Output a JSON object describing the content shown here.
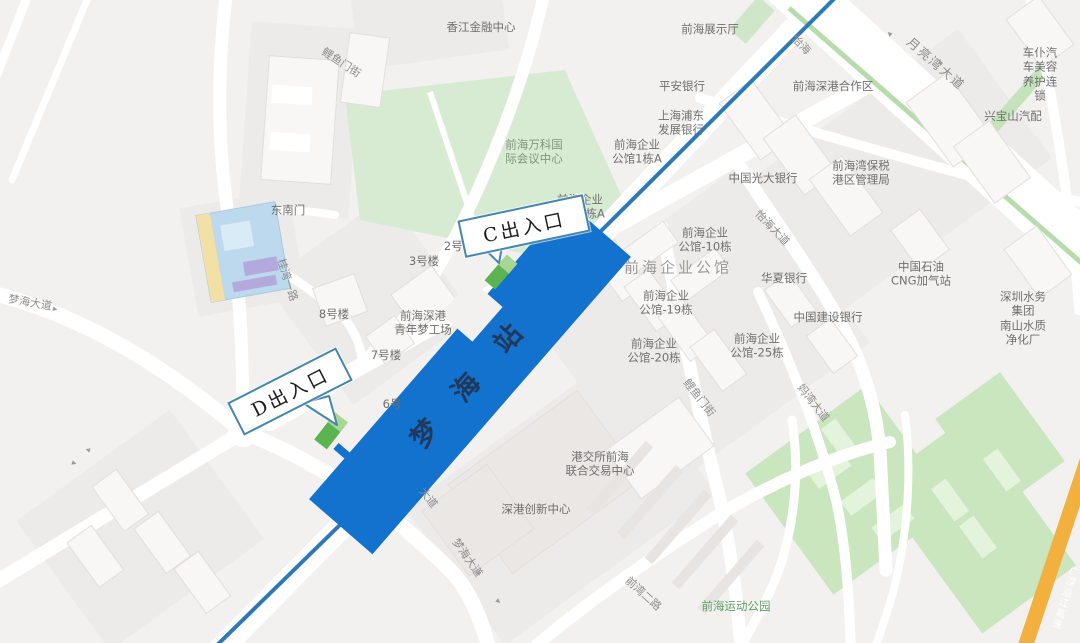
{
  "map_title": "梦海站周边地图",
  "station": {
    "name": "梦海站",
    "chars": [
      {
        "ch": "梦",
        "x": 423,
        "y": 432
      },
      {
        "ch": "海",
        "x": 464,
        "y": 386
      },
      {
        "ch": "站",
        "x": 506,
        "y": 337
      }
    ]
  },
  "callouts": [
    {
      "id": "callout-exit-c",
      "text": "C出入口",
      "x": 522,
      "y": 224,
      "rot": -12,
      "w": 124,
      "h": 34
    },
    {
      "id": "callout-exit-d",
      "text": "D出入口",
      "x": 288,
      "y": 389,
      "rot": -27,
      "w": 118,
      "h": 33
    }
  ],
  "exits": [
    {
      "id": "exit-c",
      "x": 501,
      "y": 272,
      "rot": 41
    },
    {
      "id": "exit-d",
      "x": 331,
      "y": 431,
      "rot": 38
    }
  ],
  "labels": [
    {
      "id": "road-liyumen-street-nw",
      "text": "鲤鱼门街",
      "x": 341,
      "y": 63,
      "rot": 33,
      "cls": "road"
    },
    {
      "id": "poi-xiangjiang-financial-center",
      "text": "香江金融中心",
      "x": 481,
      "y": 27,
      "cls": "poi"
    },
    {
      "id": "poi-qianhai-exhibition-hall",
      "text": "前海展示厅",
      "x": 710,
      "y": 29,
      "cls": "poi"
    },
    {
      "id": "road-yihai",
      "text": "怡海",
      "x": 801,
      "y": 45,
      "rot": 46,
      "cls": "road"
    },
    {
      "id": "road-moon-bay-blvd",
      "text": "月亮湾大道",
      "x": 936,
      "y": 64,
      "rot": 41,
      "cls": "road-big"
    },
    {
      "id": "poi-chepu-auto-beauty",
      "text": "车仆汽车美容\n养护连锁",
      "x": 1040,
      "y": 74,
      "cls": "poi"
    },
    {
      "id": "poi-xingbaoshan-auto-parts",
      "text": "兴宝山汽配",
      "x": 1013,
      "y": 116,
      "cls": "poi"
    },
    {
      "id": "poi-pingan-bank",
      "text": "平安银行",
      "x": 682,
      "y": 86,
      "cls": "poi"
    },
    {
      "id": "poi-spdb-bank",
      "text": "上海浦东\n发展银行",
      "x": 681,
      "y": 123,
      "cls": "poi"
    },
    {
      "id": "poi-qianhai-shengang-cooperation-zone",
      "text": "前海深港合作区",
      "x": 833,
      "y": 86,
      "cls": "poi"
    },
    {
      "id": "poi-bonded-port-authority",
      "text": "前海湾保税\n港区管理局",
      "x": 861,
      "y": 173,
      "cls": "poi"
    },
    {
      "id": "poi-china-everbright-bank",
      "text": "中国光大银行",
      "x": 763,
      "y": 178,
      "cls": "poi"
    },
    {
      "id": "poi-vanke-intl-conference-center",
      "text": "前海万科国\n际会议中心",
      "x": 534,
      "y": 152,
      "cls": "park-label"
    },
    {
      "id": "poi-gongguan-1a",
      "text": "前海企业\n公馆1栋A",
      "x": 637,
      "y": 152,
      "cls": "poi"
    },
    {
      "id": "poi-southeast-gate",
      "text": "东南门",
      "x": 288,
      "y": 210,
      "cls": "poi"
    },
    {
      "id": "poi-gongguan-7a",
      "text": "前海企业\n公馆7栋A",
      "x": 580,
      "y": 207,
      "cls": "poi"
    },
    {
      "id": "poi-building-2",
      "text": "2号楼",
      "x": 459,
      "y": 246,
      "cls": "poi"
    },
    {
      "id": "poi-building-3",
      "text": "3号楼",
      "x": 424,
      "y": 261,
      "cls": "poi"
    },
    {
      "id": "road-guiwan-1st",
      "text": "桂湾一路",
      "x": 287,
      "y": 280,
      "rot": 72,
      "cls": "road"
    },
    {
      "id": "poi-building-8",
      "text": "8号楼",
      "x": 334,
      "y": 314,
      "cls": "poi"
    },
    {
      "id": "road-yihai-blvd",
      "text": "怡海大道",
      "x": 772,
      "y": 228,
      "rot": 46,
      "cls": "road"
    },
    {
      "id": "poi-gongguan-10",
      "text": "前海企业\n公馆-10栋",
      "x": 705,
      "y": 240,
      "cls": "poi"
    },
    {
      "id": "poi-qianhai-enterprise-mansion",
      "text": "前海企业公馆",
      "x": 678,
      "y": 268,
      "cls": "poi-big"
    },
    {
      "id": "poi-huaxia-bank",
      "text": "华夏银行",
      "x": 784,
      "y": 278,
      "cls": "poi"
    },
    {
      "id": "poi-cnpc-cng-station",
      "text": "中国石油\nCNG加气站",
      "x": 921,
      "y": 274,
      "cls": "poi"
    },
    {
      "id": "poi-gongguan-19",
      "text": "前海企业\n公馆-19栋",
      "x": 666,
      "y": 303,
      "cls": "poi"
    },
    {
      "id": "poi-ccb-bank",
      "text": "中国建设银行",
      "x": 828,
      "y": 317,
      "cls": "poi"
    },
    {
      "id": "poi-shenzhen-water-group",
      "text": "深圳水务集团\n南山水质净化厂",
      "x": 1023,
      "y": 318,
      "cls": "poi"
    },
    {
      "id": "poi-youth-dream-works",
      "text": "前海深港\n青年梦工场",
      "x": 423,
      "y": 323,
      "cls": "poi"
    },
    {
      "id": "poi-building-7",
      "text": "7号楼",
      "x": 386,
      "y": 355,
      "cls": "poi"
    },
    {
      "id": "poi-gongguan-20",
      "text": "前海企业\n公馆-20栋",
      "x": 654,
      "y": 351,
      "cls": "poi"
    },
    {
      "id": "poi-gongguan-25",
      "text": "前海企业\n公馆-25栋",
      "x": 757,
      "y": 346,
      "cls": "poi"
    },
    {
      "id": "road-liyumen-street-e",
      "text": "鲤鱼门街",
      "x": 699,
      "y": 398,
      "rot": 52,
      "cls": "road"
    },
    {
      "id": "road-mawan-blvd",
      "text": "妈湾大道",
      "x": 813,
      "y": 403,
      "rot": 52,
      "cls": "road"
    },
    {
      "id": "road-menghai-blvd-w",
      "text": "梦海大道",
      "x": 30,
      "y": 303,
      "rot": 10,
      "cls": "road"
    },
    {
      "id": "poi-building-6",
      "text": "6号",
      "x": 392,
      "y": 404,
      "cls": "poi"
    },
    {
      "id": "road-tinghai-blvd-fragment",
      "text": "大道",
      "x": 428,
      "y": 498,
      "rot": 52,
      "cls": "road"
    },
    {
      "id": "poi-hkex-qianhai-center",
      "text": "港交所前海\n联合交易中心",
      "x": 600,
      "y": 464,
      "cls": "poi"
    },
    {
      "id": "poi-shengang-innovation-center",
      "text": "深港创新中心",
      "x": 536,
      "y": 509,
      "cls": "poi"
    },
    {
      "id": "road-menghai-blvd-s",
      "text": "梦海大道",
      "x": 467,
      "y": 558,
      "rot": 55,
      "cls": "road"
    },
    {
      "id": "road-qianwan-2nd",
      "text": "前湾二路",
      "x": 643,
      "y": 594,
      "rot": 42,
      "cls": "road"
    },
    {
      "id": "poi-qianhai-sports-park",
      "text": "前海运动公园",
      "x": 736,
      "y": 606,
      "cls": "park-label2"
    },
    {
      "id": "road-guangshen-riverside-expressway",
      "text": "广深沿江高速",
      "x": 1063,
      "y": 597,
      "rot": 18,
      "cls": "hwy"
    }
  ],
  "arrows": [
    {
      "x": 55,
      "y": 310,
      "r": 15
    },
    {
      "x": 88,
      "y": 449,
      "r": 198
    },
    {
      "x": 74,
      "y": 464,
      "r": 18
    },
    {
      "x": 890,
      "y": 33,
      "r": 225
    },
    {
      "x": 940,
      "y": 64,
      "r": 45
    },
    {
      "x": 478,
      "y": 574,
      "r": 55
    },
    {
      "x": 498,
      "y": 602,
      "r": 40
    }
  ],
  "colors": {
    "station_band_blue": "#1372cd",
    "metro_line_blue": "#2d79b8",
    "exit_green": "#5cb451",
    "exit_green_light": "#a8d795",
    "callout_border_blue": "#4486ad",
    "highway_orange": "#f2b13e",
    "park_green": "#d7ead2",
    "plant_green": "#c9e6bf",
    "median_green": "#b7dcab",
    "road_white": "#ffffff",
    "map_background": "#f2f1ef"
  }
}
